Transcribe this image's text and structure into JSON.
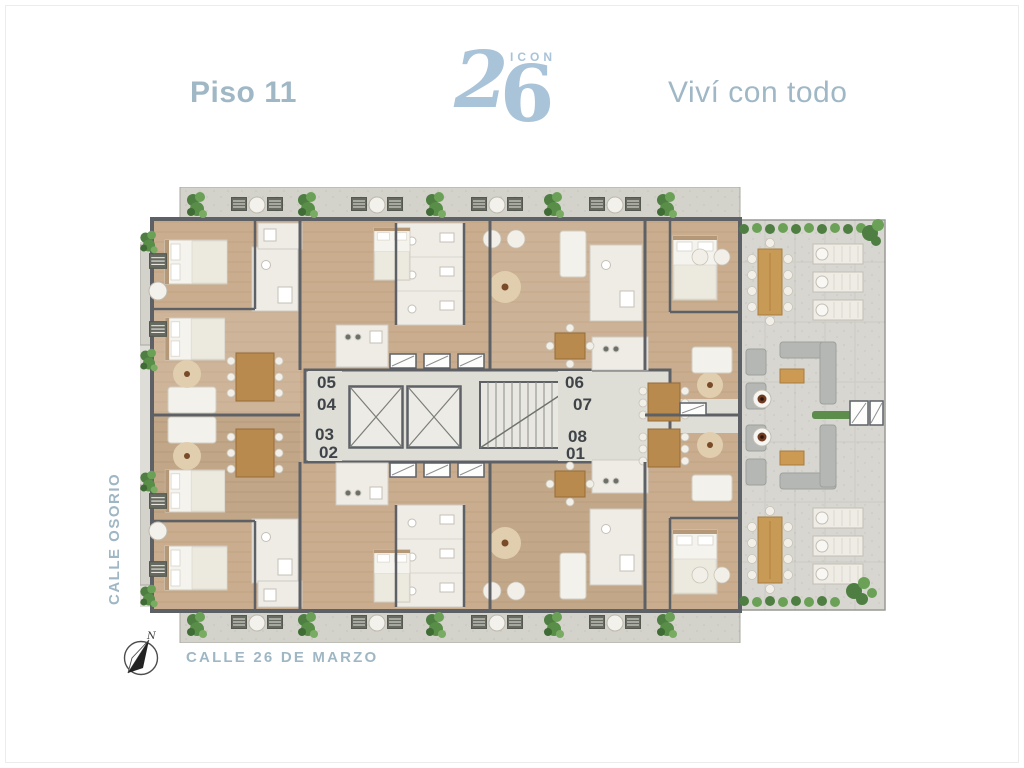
{
  "header": {
    "floor_label": "Piso 11",
    "logo": {
      "brand": "ICON",
      "digit_first": "2",
      "digit_second": "6"
    },
    "tagline": "Viví con todo"
  },
  "floorplan": {
    "units": [
      {
        "label": "05"
      },
      {
        "label": "04"
      },
      {
        "label": "03"
      },
      {
        "label": "02"
      },
      {
        "label": "06"
      },
      {
        "label": "07"
      },
      {
        "label": "08"
      },
      {
        "label": "01"
      }
    ],
    "streets": {
      "left": "CALLE OSORIO",
      "bottom": "CALLE 26 DE MARZO"
    },
    "compass_north_label": "N"
  },
  "palette": {
    "accent_blue": "#a0b8c6",
    "logo_blue": "#a9c3d9",
    "wall_gray": "#5d6166",
    "wood_floor": "#c9ad8e",
    "paving_gray": "#d3d2cb",
    "plant_green": "#629351",
    "unit_label_gray": "#3f4449"
  }
}
